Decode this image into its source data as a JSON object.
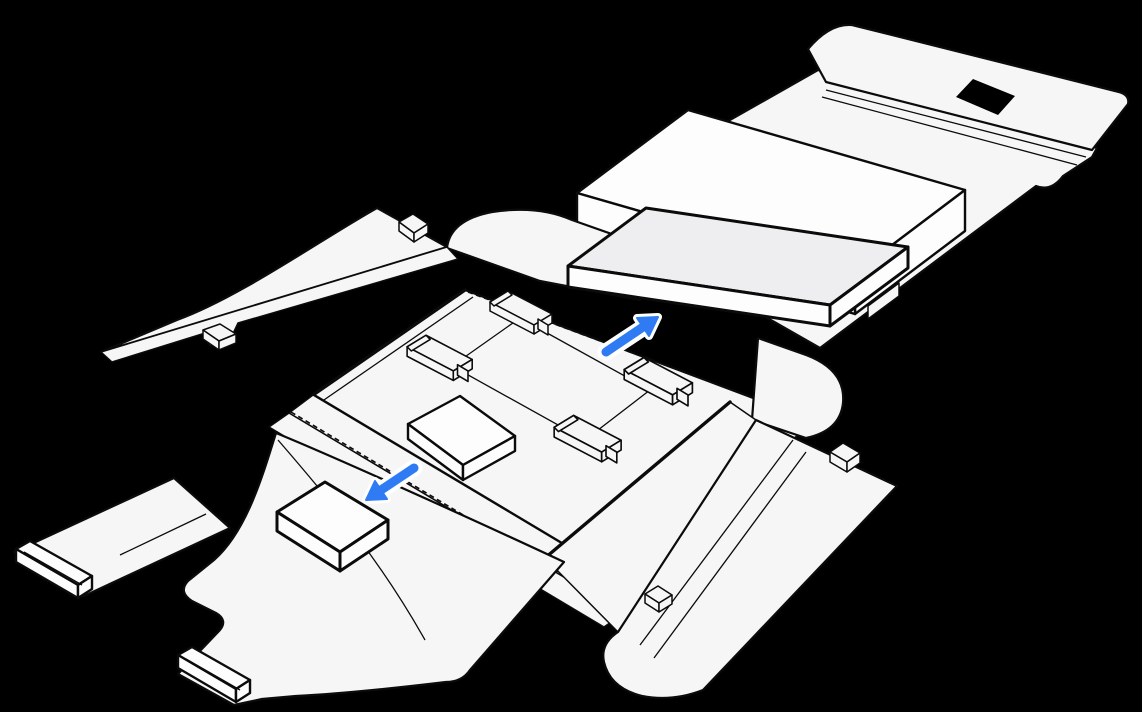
{
  "figure": {
    "label": "Line drawing of an unfolded laptop shipping box on a black background: a wrapped laptop rests on the opened lid, the main tray holds four corner protectors with an outlined spot for a small box, a small accessory box sits on the lower-left flap, and two blue arrows indicate where each item is placed.",
    "background_color": "#000000",
    "line_color": "#0b0b0b",
    "panel_fill": "#f6f6f7",
    "item_fill": "#fdfdfd",
    "laptop_fill": "#eeeef0",
    "arrow_color": "#2e7bf3",
    "arrow_halo_color": "#ffffff"
  },
  "parts": {
    "lid": "opened-lid-panel",
    "lid_top_flap": "lid-closure-flap",
    "handle": "handle-cutout",
    "wrap": "protective-wrap-slab",
    "laptop": "wrapped-laptop",
    "tray": "main-tray",
    "corner_protectors_count": 4,
    "center_box_outline": "small-box-placement-outline",
    "accessory_box": "small-accessory-box",
    "flaps": [
      "left-side-flap",
      "bottom-left-flap",
      "bottom-right-flap"
    ],
    "tabs": [
      "left-flap-tab-a",
      "left-flap-tab-b",
      "right-flap-tab",
      "flap-edge-tab"
    ],
    "rails": [
      "left-rail-tab",
      "bottom-rail-tab"
    ]
  },
  "arrows": [
    {
      "name": "arrow-up-right",
      "direction": "up-right"
    },
    {
      "name": "arrow-down-left",
      "direction": "down-left"
    }
  ]
}
